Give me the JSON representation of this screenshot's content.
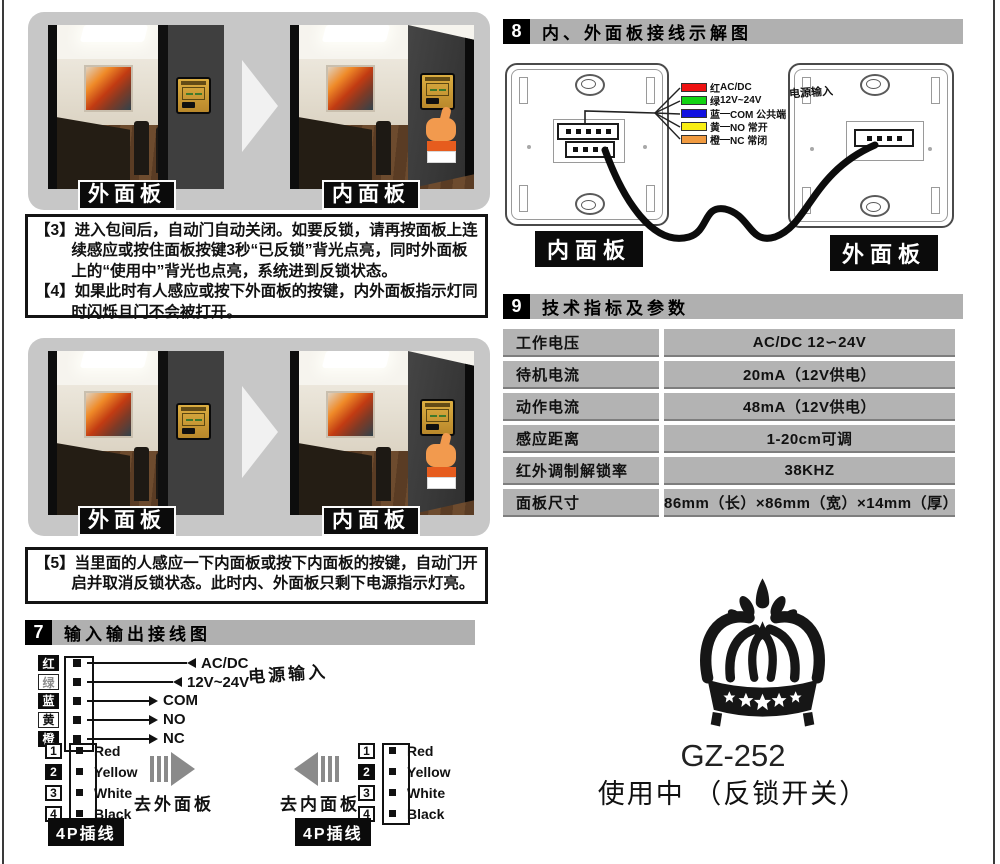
{
  "photos": {
    "block1": {
      "left_label": "外面板",
      "right_label": "内面板"
    },
    "block2": {
      "left_label": "外面板",
      "right_label": "内面板"
    }
  },
  "instructions": {
    "i3_tag": "【3】",
    "i3_text": "进入包间后，自动门自动关闭。如要反锁，请再按面板上连续感应或按住面板按键3秒“已反锁”背光点亮，同时外面板上的“使用中”背光也点亮，系统进到反锁状态。",
    "i4_tag": "【4】",
    "i4_text": "如果此时有人感应或按下外面板的按键，内外面板指示灯同时闪烁且门不会被打开。",
    "i5_tag": "【5】",
    "i5_text": "当里面的人感应一下内面板或按下内面板的按键，自动门开启并取消反锁状态。此时内、外面板只剩下电源指示灯亮。"
  },
  "section7": {
    "number": "7",
    "title": "输入输出接线图",
    "power_label": "电源输入",
    "wires": [
      {
        "label": "红",
        "desc": "AC/DC"
      },
      {
        "label": "绿",
        "desc": "12V~24V"
      },
      {
        "label": "蓝",
        "desc": "COM"
      },
      {
        "label": "黄",
        "desc": "NO"
      },
      {
        "label": "橙",
        "desc": "NC"
      }
    ],
    "plug_left": {
      "pins": [
        "1",
        "2",
        "3",
        "4"
      ],
      "wire_names": [
        "Red",
        "Yellow",
        "White",
        "Black"
      ],
      "arrow_label": "去外面板",
      "badge": "4P插线"
    },
    "plug_right": {
      "pins": [
        "1",
        "2",
        "3",
        "4"
      ],
      "wire_names": [
        "Red",
        "Yellow",
        "White",
        "Black"
      ],
      "arrow_label": "去内面板",
      "badge": "4P插线"
    }
  },
  "section8": {
    "number": "8",
    "title": "内、外面板接线示解图",
    "power_label": "电源输入",
    "legend": [
      {
        "label": "红",
        "sep": "",
        "desc": "AC/DC",
        "color": "#ee1111"
      },
      {
        "label": "绿",
        "sep": "",
        "desc": "12V~24V",
        "color": "#12d412"
      },
      {
        "label": "蓝",
        "sep": "—",
        "desc": "COM 公共端",
        "color": "#1111e0"
      },
      {
        "label": "黄",
        "sep": "—",
        "desc": "NO 常开",
        "color": "#f8ee12"
      },
      {
        "label": "橙",
        "sep": "—",
        "desc": "NC 常闭",
        "color": "#f09a40"
      }
    ],
    "inner_label": "内面板",
    "outer_label": "外面板"
  },
  "section9": {
    "number": "9",
    "title": "技术指标及参数",
    "rows": [
      {
        "param": "工作电压",
        "value": "AC/DC 12∽24V"
      },
      {
        "param": "待机电流",
        "value": "20mA（12V供电）"
      },
      {
        "param": "动作电流",
        "value": "48mA（12V供电）"
      },
      {
        "param": "感应距离",
        "value": "1-20cm可调"
      },
      {
        "param": "红外调制解锁率",
        "value": "38KHZ"
      },
      {
        "param": "面板尺寸",
        "value": "86mm（长）×86mm（宽）×14mm（厚）"
      }
    ]
  },
  "brand": {
    "model": "GZ-252",
    "subtitle": "使用中 （反锁开关）"
  }
}
